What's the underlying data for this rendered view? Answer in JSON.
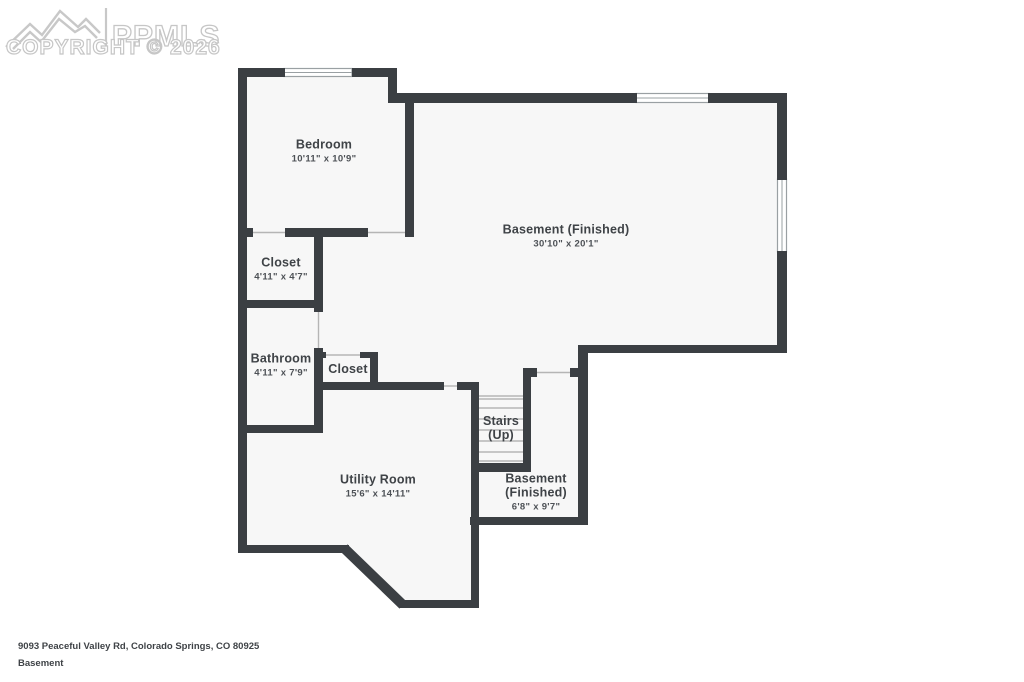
{
  "watermark": {
    "logo_text": "PPMLS",
    "copyright": "COPYRIGHT © 2026",
    "logo_icon": "mountain-range-icon"
  },
  "rooms": [
    {
      "name": "Bedroom",
      "dims": "10'11\" x 10'9\""
    },
    {
      "name": "Basement (Finished)",
      "dims": "30'10\" x 20'1\""
    },
    {
      "name": "Closet",
      "dims": "4'11\" x 4'7\""
    },
    {
      "name": "Bathroom",
      "dims": "4'11\" x 7'9\""
    },
    {
      "name": "Closet",
      "dims": ""
    },
    {
      "name": "Stairs",
      "name2": "(Up)",
      "dims": ""
    },
    {
      "name": "Utility Room",
      "dims": "15'6\" x 14'11\""
    },
    {
      "name": "Basement",
      "name2": "(Finished)",
      "dims": "6'8\" x 9'7\""
    }
  ],
  "footer": {
    "address": "9093 Peaceful Valley Rd, Colorado Springs, CO 80925",
    "floor_label": "Basement",
    "disclaimer": "Floor plans/tour cannot be used for building or design purposes. Sizes and dimensions are approximate."
  },
  "colors": {
    "wall": "#3b3f43",
    "floor": "#f7f7f7",
    "label_text": "#3f4347",
    "watermark": "#c6c6c6",
    "door_line": "#b5b5b5",
    "window_border": "#9aa0a3",
    "tread_line": "#a8a8a8"
  }
}
